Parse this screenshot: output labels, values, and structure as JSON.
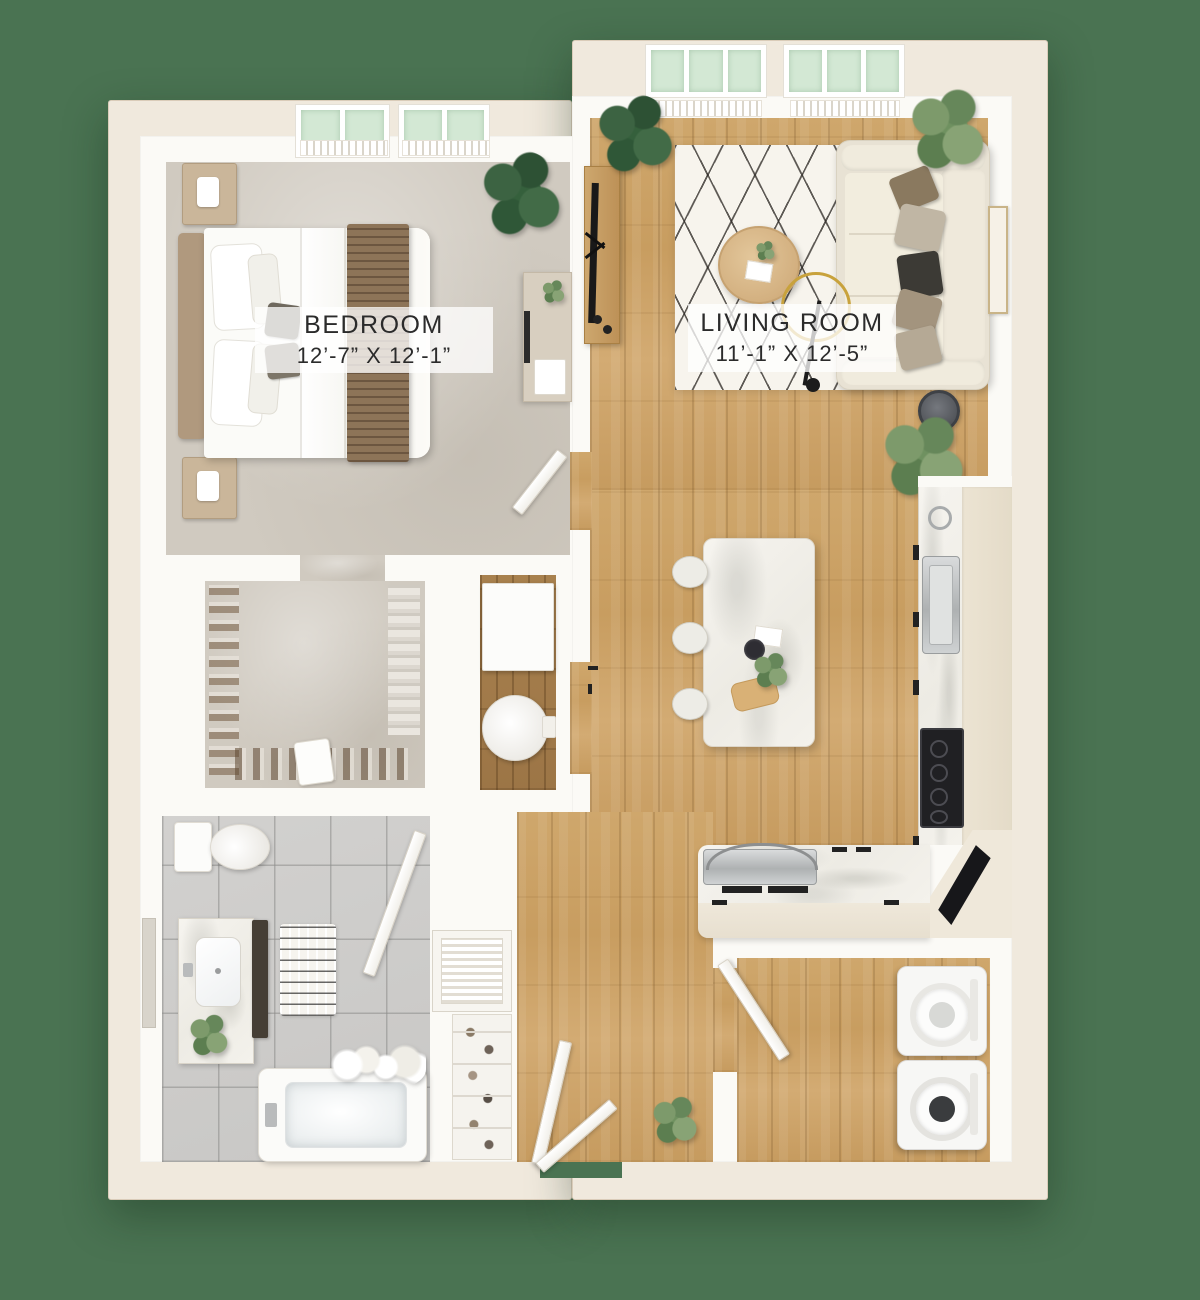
{
  "title": "One-bedroom apartment 3D floor plan",
  "background_color": "#4a7352",
  "palette": {
    "outer_wall": "#f0e9dd",
    "inner_wall": "#fbfaf6",
    "hardwood": "#cfa76c",
    "dark_hardwood": "#a8814e",
    "carpet": "#d0cac0",
    "tile": "#cdccca",
    "marble": "#f4f2ec",
    "rug": "#f7f4ed",
    "window_glass": "#d3e8d4",
    "label_text": "#2b2b2b"
  },
  "labels": {
    "bedroom": {
      "name": "BEDROOM",
      "dims": "12’-7” X 12’-1”"
    },
    "living_room": {
      "name": "LIVING ROOM",
      "dims": "11’-1” X 12’-5”"
    }
  },
  "rooms": {
    "bedroom": {
      "floor": "carpet",
      "items": [
        "bed",
        "headboard",
        "pillows",
        "striped-throw-blanket",
        "nightstand-top",
        "nightstand-bottom",
        "potted-plant",
        "desk",
        "desk-monitor",
        "desk-tray",
        "door",
        "windows"
      ]
    },
    "living_room": {
      "floor": "hardwood",
      "items": [
        "diamond-area-rug",
        "round-coffee-table",
        "sofa",
        "throw-pillows",
        "tv-console",
        "tv",
        "floor-lamp",
        "corner-plants",
        "robot-vacuum",
        "wall-art",
        "windows"
      ]
    },
    "walk_in_closet": {
      "floor": "carpet",
      "items": [
        "shoe-rows",
        "hanging-clothes",
        "storage-bag"
      ]
    },
    "water_closet": {
      "floor": "dark-hardwood",
      "items": [
        "cabinet",
        "round-toilet"
      ]
    },
    "bathroom": {
      "floor": "tile",
      "items": [
        "toilet",
        "vanity-with-sink",
        "mirror",
        "dark-cabinet-tower",
        "chevron-bath-mat",
        "bathtub",
        "shower-curtain",
        "plant",
        "door"
      ]
    },
    "kitchen": {
      "floor": "hardwood",
      "items": [
        "marble-island",
        "bar-stools-3",
        "island-decor",
        "sink-and-faucet",
        "cooktop",
        "oven-with-arc-handle",
        "counter-run",
        "corner-counter",
        "cabinet-handles"
      ]
    },
    "laundry": {
      "floor": "hardwood",
      "items": [
        "washer",
        "dryer",
        "door"
      ]
    },
    "entry": {
      "floor": "hardwood",
      "items": [
        "double-entry-doors",
        "potted-plant",
        "louvered-utility-closet",
        "shoe-shelf-closet"
      ]
    }
  },
  "window_counts": {
    "living_room": 2,
    "bedroom": 2
  }
}
